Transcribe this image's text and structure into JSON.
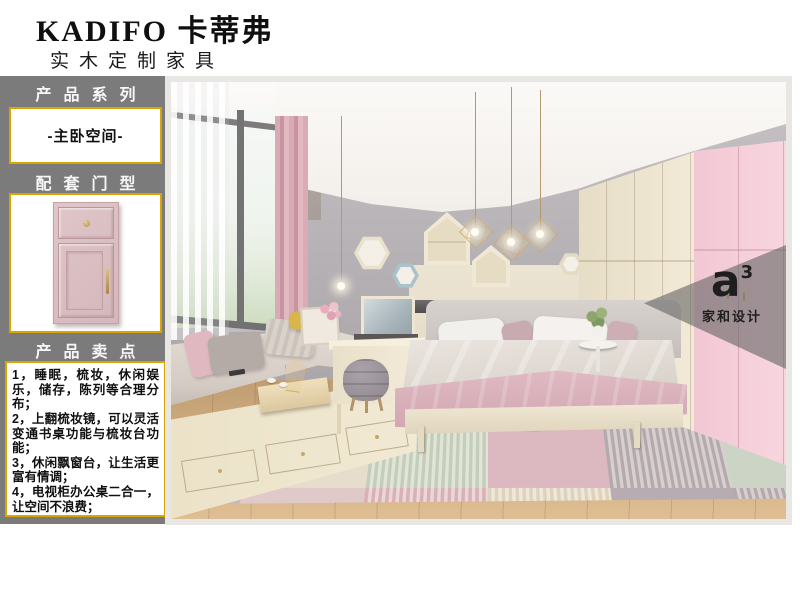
{
  "brand": {
    "name": "KADIFO 卡蒂弗",
    "tagline": "实木定制家具"
  },
  "sidebar": {
    "series_label": "产品系列",
    "series_value": "-主卧空间-",
    "door_label": "配套门型",
    "points_label": "产品卖点",
    "selling_points": [
      "1，睡眠，梳妆，休闲娱乐，储存，陈列等合理分布；",
      "2，上翻梳妆镜，可以灵活变通书桌功能与梳妆台功能；",
      "3，休闲飘窗台，让生活更富有情调；",
      "4，电视柜办公桌二合一，让空间不浪费；"
    ]
  },
  "photo": {
    "watermark_logo": "a",
    "watermark_sup": "3",
    "watermark_caption": "家和设计"
  },
  "colors": {
    "sidebar_bg": "#7b7b7b",
    "box_border": "#d9a404",
    "door_pink": "#d9bec1",
    "wardrobe_cream": "#ece3cd",
    "wardrobe_pink": "#f4cbd7",
    "accent_gold": "#c9a866"
  }
}
